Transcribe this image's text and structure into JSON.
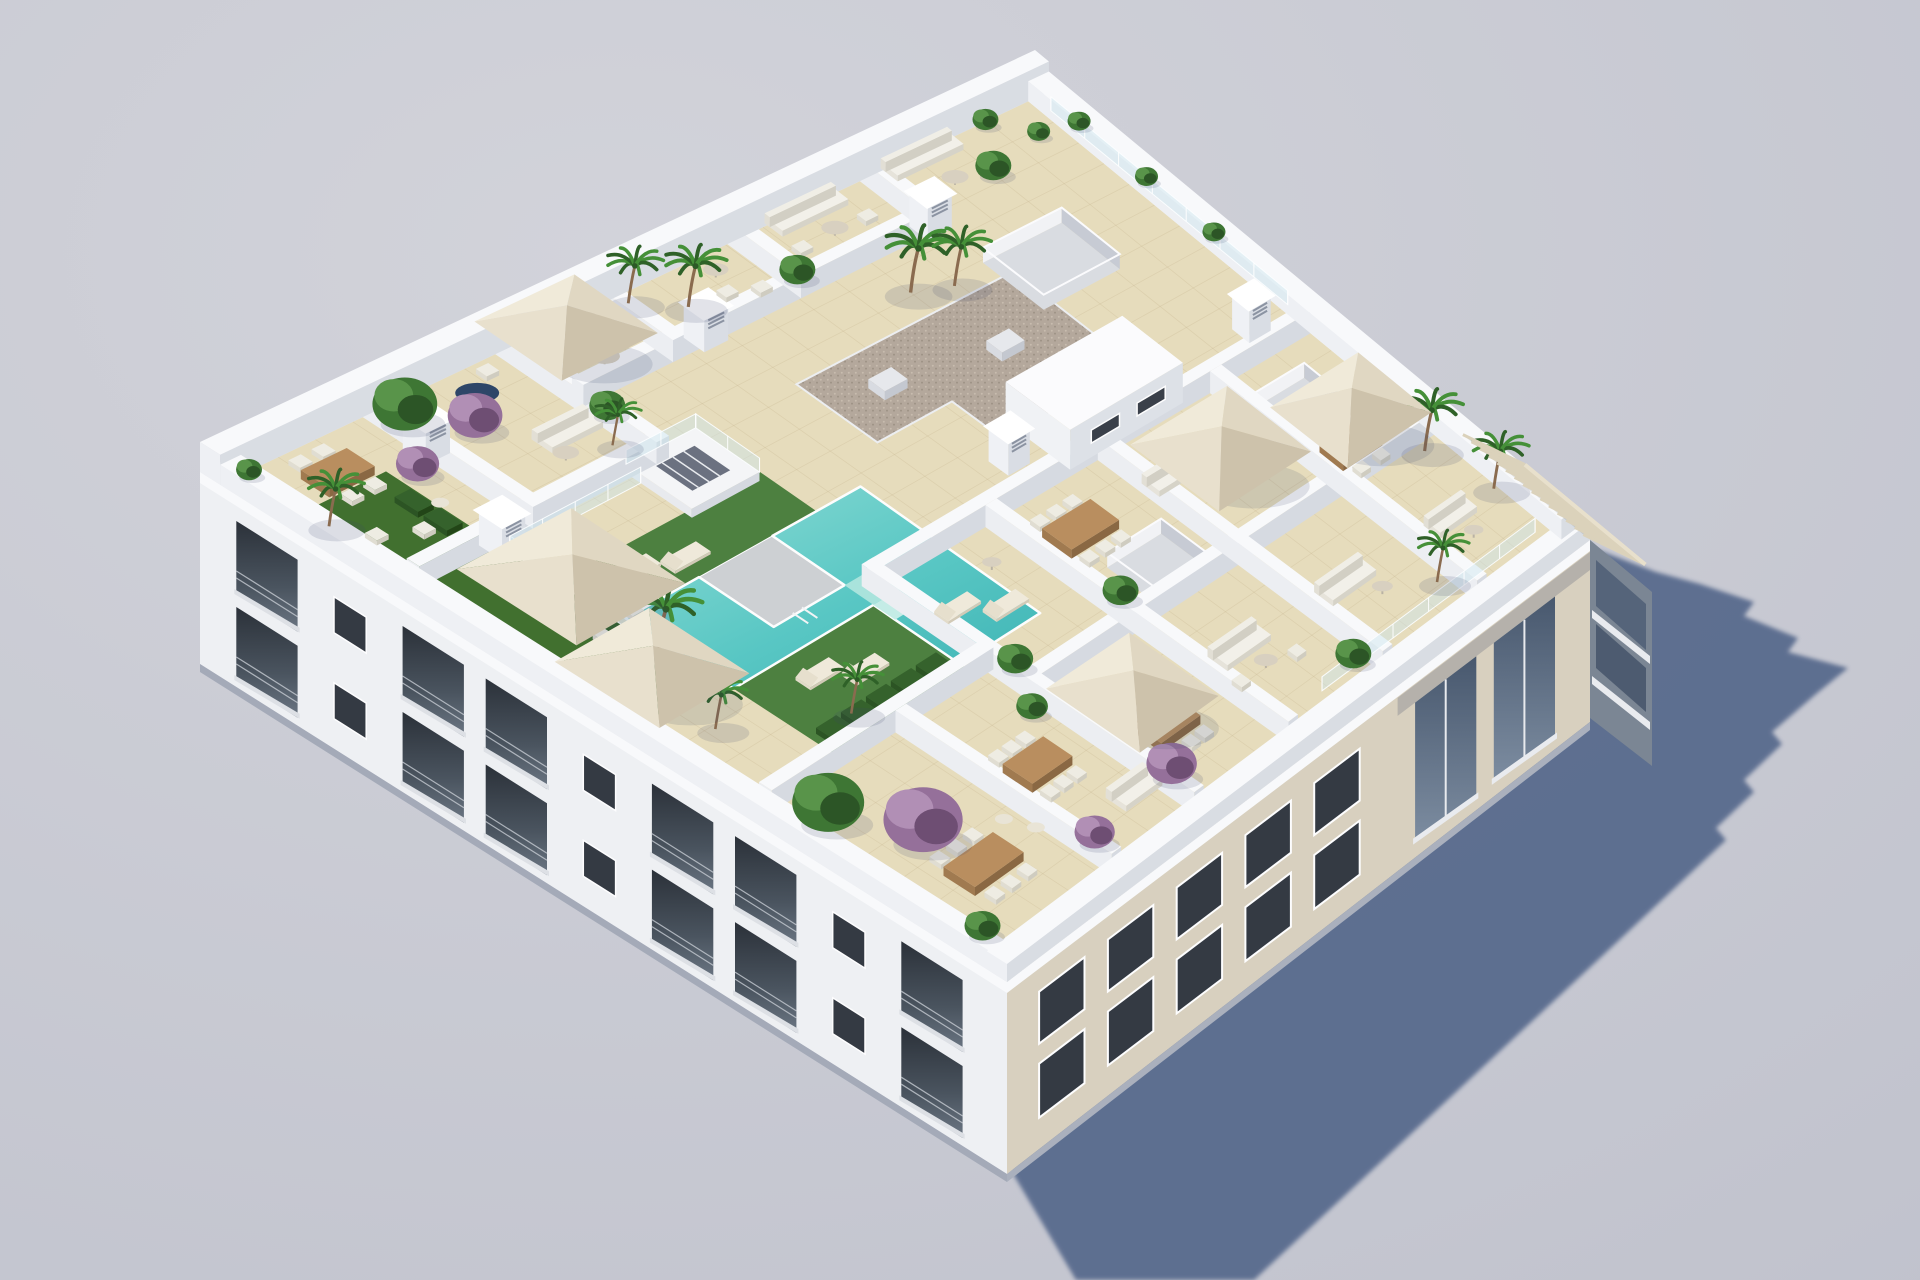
{
  "scene": {
    "type": "3d-architectural-render",
    "subject": "Aerial axonometric view of a white residential apartment block with a landscaped rooftop: communal pool deck, artificial lawns, walled private terraces with outdoor furniture, planted palms and flowering shrubs",
    "background": "plain light grey studio backdrop",
    "lighting": "sun from upper left casting one long blue-grey shadow to the lower right",
    "camera": "high angle isometric from the south-west"
  },
  "palette": {
    "bg1": "#d2d3da",
    "bg2": "#bfc1cc",
    "shadow": "#56698c",
    "white": "#f3f4f6",
    "parapet": "#f8f9fb",
    "tile": "#e6dcbc",
    "tileLine": "#c4b28c",
    "beigeWall": "#d8d0bf",
    "pool1": "#8edcd5",
    "pool2": "#3db3b4",
    "lawn": "#4d8040",
    "hedge": "#2c5424",
    "gravel": "#b4a89c",
    "wood": "#b98e5f",
    "canvas": "#efe8d8",
    "canvasShade": "#cdc2ab",
    "glass": "#cde4ee",
    "windowDark": "#343a43",
    "frame": "#fdfdfe",
    "greenPlant": "#3e7634",
    "purplePlant": "#95709a",
    "whiteFurniture": "#f2f0e9"
  },
  "objects": {
    "building": {
      "floors_visible": 3,
      "facade_sw": "white, two rows of recessed glass balconies",
      "facade_se": "beige, two rows of punched windows and corner balcony recesses",
      "pergola": "timber slat pergola over east corner terrace"
    },
    "rooftop": {
      "pool": 1,
      "pool_deck": 1,
      "lawn_patches": 3,
      "hedges": 2,
      "umbrellas": 6,
      "sun_loungers": 6,
      "dining_sets": 6,
      "sofa_sets": 9,
      "round_tables": 9,
      "light_wells": 4,
      "stair_bulkhead": 1,
      "gravel_roof": 1,
      "chimneys": 6,
      "palm_trees": 12,
      "green_shrubs": 10,
      "purple_shrubs": 5,
      "glass_balustrades": 4
    }
  }
}
